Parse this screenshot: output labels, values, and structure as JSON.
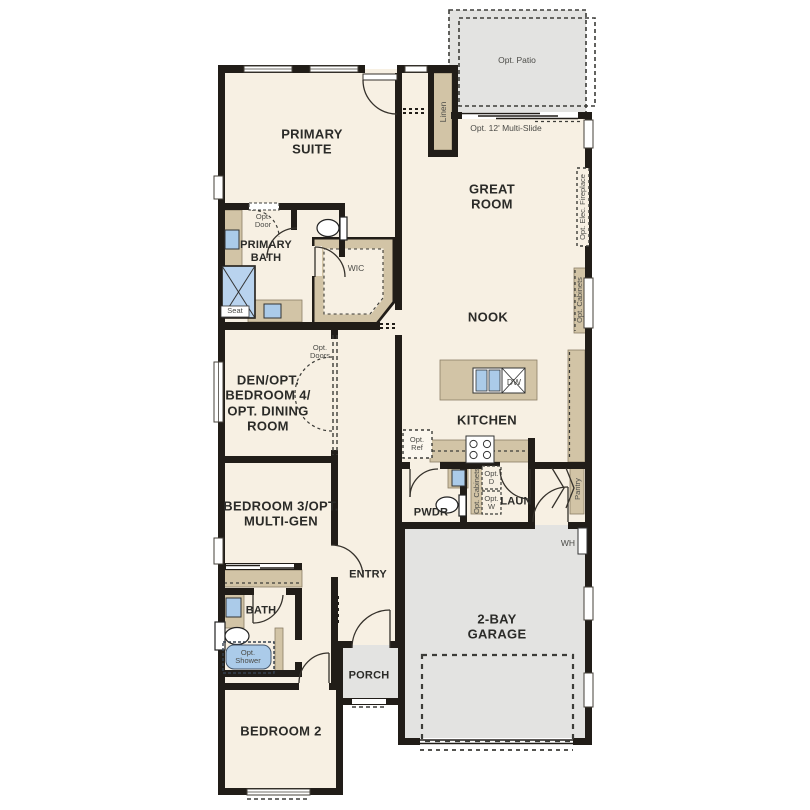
{
  "plan_title": "single-story floor plan",
  "labels": {
    "opt_patio": "Opt. Patio",
    "linen": "Linen",
    "multi_slide": "Opt. 12' Multi-Slide",
    "primary_suite": "PRIMARY\nSUITE",
    "great_room": "GREAT\nROOM",
    "opt_elec_fireplace": "Opt. Elec. Fireplace",
    "opt_cabinets_wall": "Opt. Cabinets",
    "nook": "NOOK",
    "opt_door": "Opt.\nDoor",
    "primary_bath": "PRIMARY\nBATH",
    "seat": "Seat",
    "wic": "WIC",
    "den": "DEN/OPT.\nBEDROOM 4/\nOPT. DINING\nROOM",
    "opt_doors": "Opt.\nDoors",
    "kitchen": "KITCHEN",
    "dw": "DW",
    "opt_ref": "Opt.\nRef",
    "opt_cabinets_laundry": "Opt. Cabinets",
    "opt_dryer": "Opt.\nD",
    "opt_washer": "Opt.\nW",
    "laundry": "LAUN",
    "powder": "PWDR",
    "pantry": "Pantry",
    "water_heater": "WH",
    "bedroom3": "BEDROOM 3/OPT.\nMULTI-GEN",
    "entry": "ENTRY",
    "bath": "BATH",
    "opt_shower": "Opt.\nShower",
    "porch": "PORCH",
    "garage": "2-BAY\nGARAGE",
    "bedroom2": "BEDROOM 2"
  },
  "colors": {
    "wall": "#211d18",
    "floor": "#f7f0e3",
    "cabinet": "#d2c4a6",
    "outdoor_gray": "#e3e3e1",
    "fixture_blue": "#abcbe9",
    "dash_line": "#3c3c38"
  }
}
